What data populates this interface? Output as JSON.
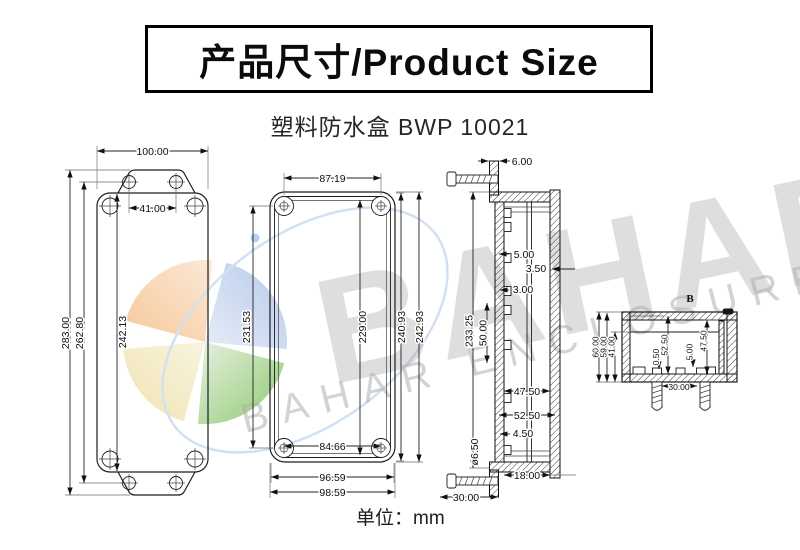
{
  "header": {
    "title": "产品尺寸/Product Size"
  },
  "subtitle": "塑料防水盒 BWP 10021",
  "footer": {
    "unit_label": "单位：mm"
  },
  "watermark": {
    "brand_word": "BAHAR",
    "brand_phrase": "BAHAR ENCLOSURE",
    "logo_colors": {
      "orange": "#f5bf8a",
      "blue": "#a9c1e8",
      "yellow": "#eedfa4",
      "green": "#7dbf56"
    }
  },
  "views": {
    "front": {
      "dims": {
        "overall_width": "100.00",
        "mount_hole_spacing": "41.00",
        "body_height": "242.13",
        "mount_hole_span": "262.80",
        "overall_height": "283.00"
      }
    },
    "open_box": {
      "dims": {
        "inner_top_width": "87.19",
        "inner_height_left": "231.53",
        "inner_height": "229.00",
        "body_height": "240.93",
        "overall_height": "242.93",
        "inner_bottom_width": "84.66",
        "body_width": "96.59",
        "overall_width": "98.59"
      }
    },
    "side_section": {
      "dims": {
        "flange_thickness": "6.00",
        "boss_width": "5.00",
        "lid_wall_thickness": "3.50",
        "wall_thickness": "3.00",
        "inner_height": "233.25",
        "boss_pitch": "50.00",
        "inner_width": "47.50",
        "mid_width": "52.50",
        "rib": "4.50",
        "flange_hole_dia": "ø6.50",
        "base_depth": "18.00",
        "screw_length": "30.00"
      }
    },
    "detail_b": {
      "label": "B",
      "dims": {
        "overall_height": "60.00",
        "inner_height": "59.00",
        "cavity_depth": "41.00",
        "gap": "0.50",
        "inner_span": "52.50",
        "boss_height": "5.00",
        "inner_depth": "47.50",
        "screw_spacing": "30.00"
      }
    }
  }
}
